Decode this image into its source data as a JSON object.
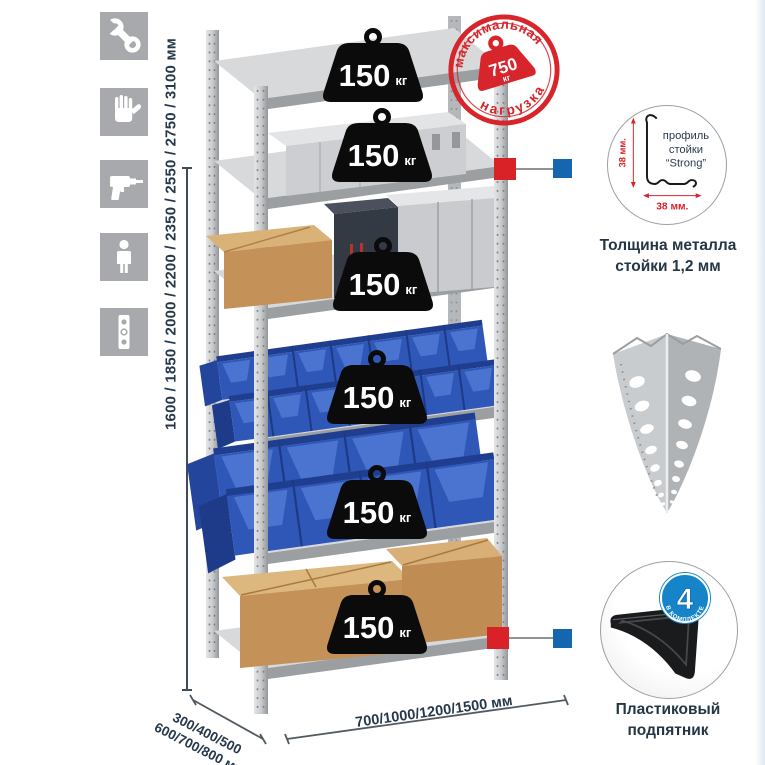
{
  "colors": {
    "accent_red": "#d7252b",
    "connector_blue": "#1566b0",
    "badge_blue": "#1584c8",
    "text_navy": "#26384a",
    "icon_bg": "#a7a9ac"
  },
  "left_icons": [
    {
      "name": "wrench"
    },
    {
      "name": "gloves"
    },
    {
      "name": "drill"
    },
    {
      "name": "person"
    },
    {
      "name": "level"
    }
  ],
  "height_dimension": {
    "label": "1600 / 1850 / 2000 / 2200 / 2350 / 2550 / 2750 / 3100 мм"
  },
  "base_dimensions": {
    "depth_line1": "300/400/500",
    "depth_line2": "600/700/800 мм",
    "width": "700/1000/1200/1500 мм"
  },
  "max_load_stamp": {
    "top_text": "максимальная",
    "bottom_text": "нагрузка",
    "value": "750",
    "unit": "кг"
  },
  "shelves": [
    {
      "load": "150",
      "unit": "кг"
    },
    {
      "load": "150",
      "unit": "кг"
    },
    {
      "load": "150",
      "unit": "кг"
    },
    {
      "load": "150",
      "unit": "кг"
    },
    {
      "load": "150",
      "unit": "кг"
    },
    {
      "load": "150",
      "unit": "кг"
    }
  ],
  "post_profile": {
    "height_dim": "38 мм.",
    "width_dim": "38 мм.",
    "label_line1": "профиль",
    "label_line2": "стойки",
    "label_line3": "“Strong”",
    "caption_line1": "Толщина металла",
    "caption_line2": "стойки 1,2 мм"
  },
  "plastic_foot": {
    "badge_value": "4",
    "badge_text": "В КОМПЛЕКТЕ",
    "caption_line1": "Пластиковый",
    "caption_line2": "подпятник"
  }
}
